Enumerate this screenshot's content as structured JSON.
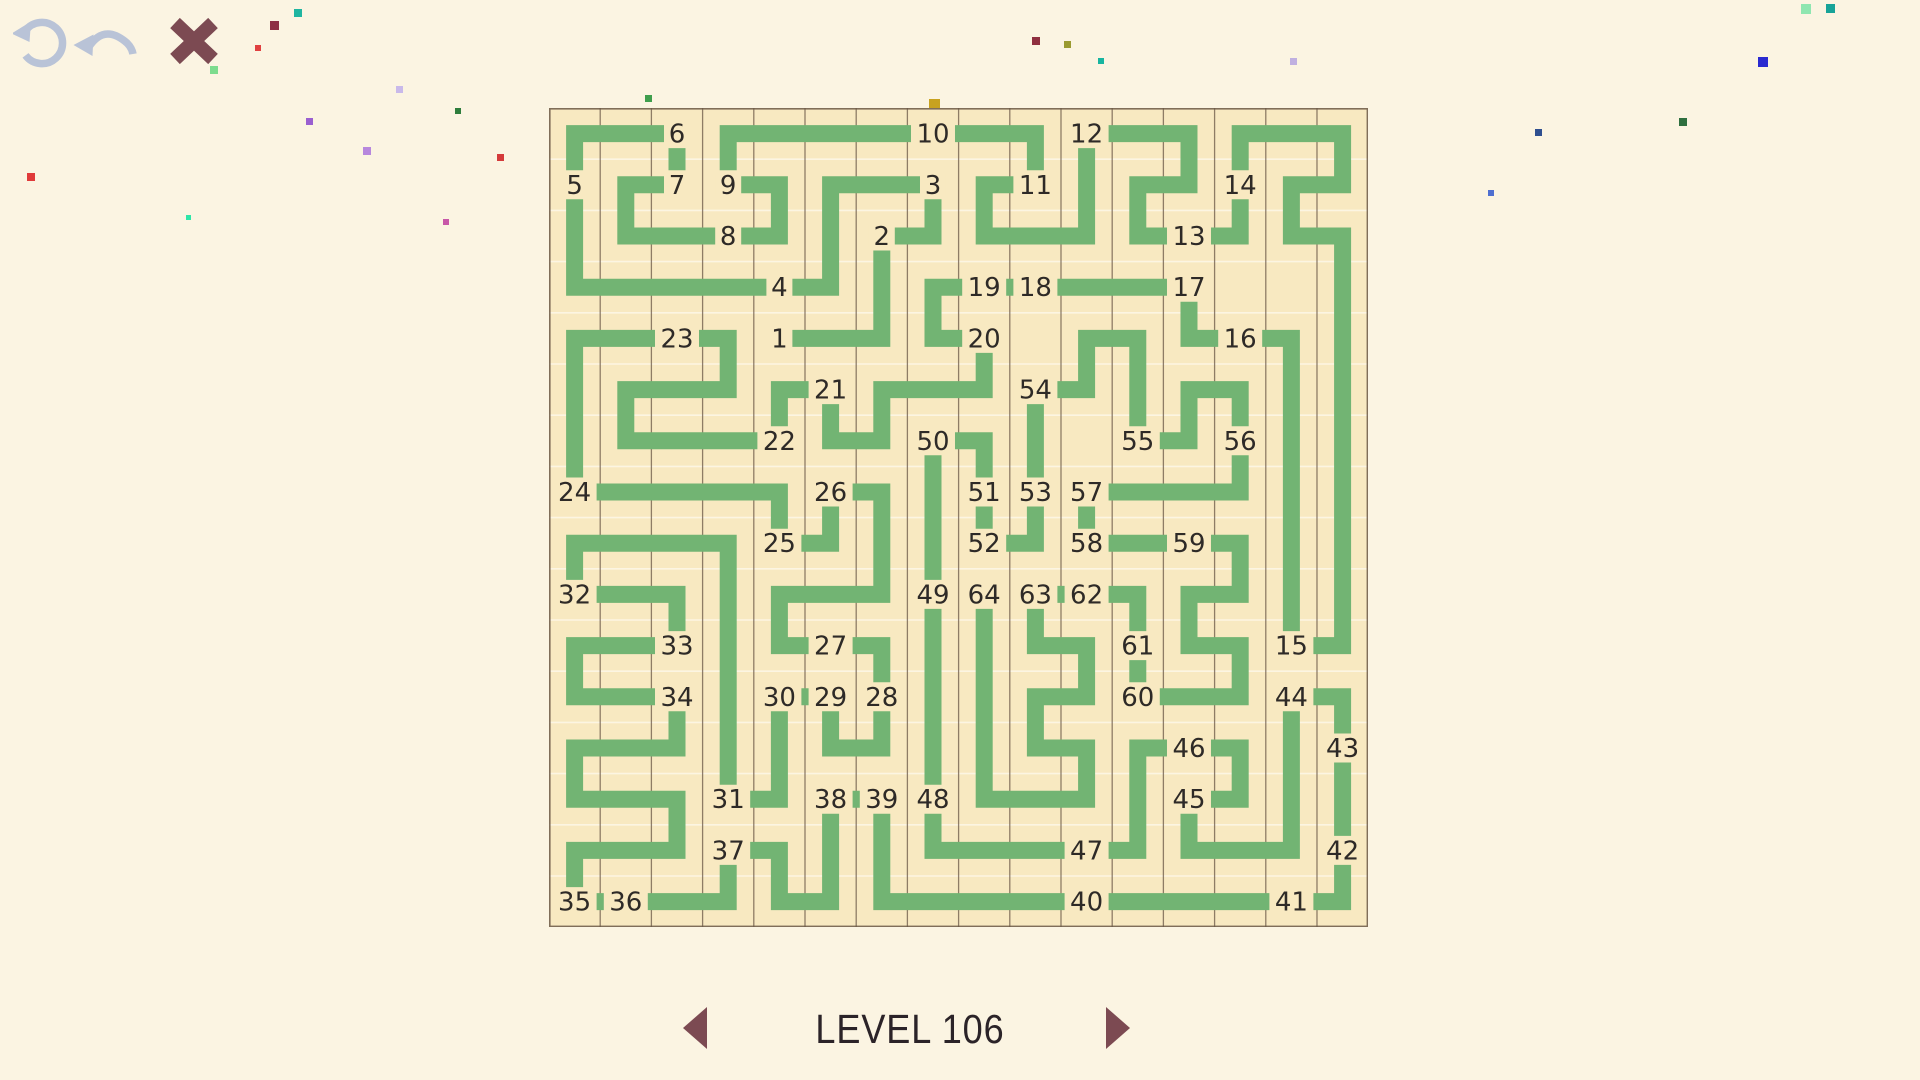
{
  "window": {
    "width": 1920,
    "height": 1080,
    "background": "#fbf4e2"
  },
  "toolbar": {
    "restart_icon_color": "#b9c3d7",
    "undo_icon_color": "#b9c3d7",
    "close_icon_color": "#7c4a52"
  },
  "level_nav": {
    "label": "LEVEL 106",
    "arrow_color": "#7c4a52"
  },
  "maze": {
    "left": 549,
    "top": 108,
    "cols": 16,
    "rows": 16,
    "cell_size": 51.2,
    "colors": {
      "board_bg": "#f8e9c1",
      "path": "#72b473",
      "grid_vertical": "#6b5847",
      "grid_horizontal": "#fdf7e6",
      "border": "#6b5847",
      "number": "#2e2a27",
      "number_halo": "#f8e9c1"
    },
    "path_stroke_width": 17,
    "numbers": [
      {
        "n": 1,
        "c": 4,
        "r": 4
      },
      {
        "n": 2,
        "c": 6,
        "r": 2
      },
      {
        "n": 3,
        "c": 7,
        "r": 1
      },
      {
        "n": 4,
        "c": 4,
        "r": 3
      },
      {
        "n": 5,
        "c": 0,
        "r": 1
      },
      {
        "n": 6,
        "c": 2,
        "r": 0
      },
      {
        "n": 7,
        "c": 2,
        "r": 1
      },
      {
        "n": 8,
        "c": 3,
        "r": 2
      },
      {
        "n": 9,
        "c": 3,
        "r": 1
      },
      {
        "n": 10,
        "c": 7,
        "r": 0
      },
      {
        "n": 11,
        "c": 9,
        "r": 1
      },
      {
        "n": 12,
        "c": 10,
        "r": 0
      },
      {
        "n": 13,
        "c": 12,
        "r": 2
      },
      {
        "n": 14,
        "c": 13,
        "r": 1
      },
      {
        "n": 15,
        "c": 14,
        "r": 10
      },
      {
        "n": 16,
        "c": 13,
        "r": 4
      },
      {
        "n": 17,
        "c": 12,
        "r": 3
      },
      {
        "n": 18,
        "c": 9,
        "r": 3
      },
      {
        "n": 19,
        "c": 8,
        "r": 3
      },
      {
        "n": 20,
        "c": 8,
        "r": 4
      },
      {
        "n": 21,
        "c": 5,
        "r": 5
      },
      {
        "n": 22,
        "c": 4,
        "r": 6
      },
      {
        "n": 23,
        "c": 2,
        "r": 4
      },
      {
        "n": 24,
        "c": 0,
        "r": 7
      },
      {
        "n": 25,
        "c": 4,
        "r": 8
      },
      {
        "n": 26,
        "c": 5,
        "r": 7
      },
      {
        "n": 27,
        "c": 5,
        "r": 10
      },
      {
        "n": 28,
        "c": 6,
        "r": 11
      },
      {
        "n": 29,
        "c": 5,
        "r": 11
      },
      {
        "n": 30,
        "c": 4,
        "r": 11
      },
      {
        "n": 31,
        "c": 3,
        "r": 13
      },
      {
        "n": 32,
        "c": 0,
        "r": 9
      },
      {
        "n": 33,
        "c": 2,
        "r": 10
      },
      {
        "n": 34,
        "c": 2,
        "r": 11
      },
      {
        "n": 35,
        "c": 0,
        "r": 15
      },
      {
        "n": 36,
        "c": 1,
        "r": 15
      },
      {
        "n": 37,
        "c": 3,
        "r": 14
      },
      {
        "n": 38,
        "c": 5,
        "r": 13
      },
      {
        "n": 39,
        "c": 6,
        "r": 13
      },
      {
        "n": 40,
        "c": 10,
        "r": 15
      },
      {
        "n": 41,
        "c": 14,
        "r": 15
      },
      {
        "n": 42,
        "c": 15,
        "r": 14
      },
      {
        "n": 43,
        "c": 15,
        "r": 12
      },
      {
        "n": 44,
        "c": 14,
        "r": 11
      },
      {
        "n": 45,
        "c": 12,
        "r": 13
      },
      {
        "n": 46,
        "c": 12,
        "r": 12
      },
      {
        "n": 47,
        "c": 10,
        "r": 14
      },
      {
        "n": 48,
        "c": 7,
        "r": 13
      },
      {
        "n": 49,
        "c": 7,
        "r": 9
      },
      {
        "n": 50,
        "c": 7,
        "r": 6
      },
      {
        "n": 51,
        "c": 8,
        "r": 7
      },
      {
        "n": 52,
        "c": 8,
        "r": 8
      },
      {
        "n": 53,
        "c": 9,
        "r": 7
      },
      {
        "n": 54,
        "c": 9,
        "r": 5
      },
      {
        "n": 55,
        "c": 11,
        "r": 6
      },
      {
        "n": 56,
        "c": 13,
        "r": 6
      },
      {
        "n": 57,
        "c": 10,
        "r": 7
      },
      {
        "n": 58,
        "c": 10,
        "r": 8
      },
      {
        "n": 59,
        "c": 12,
        "r": 8
      },
      {
        "n": 60,
        "c": 11,
        "r": 11
      },
      {
        "n": 61,
        "c": 11,
        "r": 10
      },
      {
        "n": 62,
        "c": 10,
        "r": 9
      },
      {
        "n": 63,
        "c": 9,
        "r": 9
      },
      {
        "n": 64,
        "c": 8,
        "r": 9
      }
    ],
    "path_cells": [
      [
        4,
        4
      ],
      [
        6,
        4
      ],
      [
        6,
        2
      ],
      [
        7,
        2
      ],
      [
        7,
        1
      ],
      [
        5,
        1
      ],
      [
        5,
        3
      ],
      [
        0,
        3
      ],
      [
        0,
        0
      ],
      [
        2,
        0
      ],
      [
        2,
        1
      ],
      [
        1,
        1
      ],
      [
        1,
        2
      ],
      [
        4,
        2
      ],
      [
        4,
        1
      ],
      [
        3,
        1
      ],
      [
        3,
        0
      ],
      [
        9,
        0
      ],
      [
        9,
        1
      ],
      [
        8,
        1
      ],
      [
        8,
        2
      ],
      [
        10,
        2
      ],
      [
        10,
        0
      ],
      [
        12,
        0
      ],
      [
        12,
        1
      ],
      [
        11,
        1
      ],
      [
        11,
        2
      ],
      [
        13,
        2
      ],
      [
        13,
        0
      ],
      [
        15,
        0
      ],
      [
        15,
        1
      ],
      [
        14,
        1
      ],
      [
        14,
        2
      ],
      [
        15,
        2
      ],
      [
        15,
        10
      ],
      [
        14,
        10
      ],
      [
        14,
        4
      ],
      [
        12,
        4
      ],
      [
        12,
        3
      ],
      [
        7,
        3
      ],
      [
        7,
        4
      ],
      [
        8,
        4
      ],
      [
        8,
        5
      ],
      [
        6,
        5
      ],
      [
        6,
        6
      ],
      [
        5,
        6
      ],
      [
        5,
        5
      ],
      [
        4,
        5
      ],
      [
        4,
        6
      ],
      [
        1,
        6
      ],
      [
        1,
        5
      ],
      [
        3,
        5
      ],
      [
        3,
        4
      ],
      [
        0,
        4
      ],
      [
        0,
        7
      ],
      [
        4,
        7
      ],
      [
        4,
        8
      ],
      [
        5,
        8
      ],
      [
        5,
        7
      ],
      [
        6,
        7
      ],
      [
        6,
        9
      ],
      [
        4,
        9
      ],
      [
        4,
        10
      ],
      [
        6,
        10
      ],
      [
        6,
        12
      ],
      [
        5,
        12
      ],
      [
        5,
        11
      ],
      [
        4,
        11
      ],
      [
        4,
        13
      ],
      [
        3,
        13
      ],
      [
        3,
        8
      ],
      [
        0,
        8
      ],
      [
        0,
        9
      ],
      [
        2,
        9
      ],
      [
        2,
        10
      ],
      [
        0,
        10
      ],
      [
        0,
        11
      ],
      [
        2,
        11
      ],
      [
        2,
        12
      ],
      [
        0,
        12
      ],
      [
        0,
        13
      ],
      [
        2,
        13
      ],
      [
        2,
        14
      ],
      [
        0,
        14
      ],
      [
        0,
        15
      ],
      [
        3,
        15
      ],
      [
        3,
        14
      ],
      [
        4,
        14
      ],
      [
        4,
        15
      ],
      [
        5,
        15
      ],
      [
        5,
        13
      ],
      [
        6,
        13
      ],
      [
        6,
        15
      ],
      [
        15,
        15
      ],
      [
        15,
        11
      ],
      [
        14,
        11
      ],
      [
        14,
        14
      ],
      [
        12,
        14
      ],
      [
        12,
        13
      ],
      [
        13,
        13
      ],
      [
        13,
        12
      ],
      [
        11,
        12
      ],
      [
        11,
        14
      ],
      [
        7,
        14
      ],
      [
        7,
        6
      ],
      [
        8,
        6
      ],
      [
        8,
        8
      ],
      [
        9,
        8
      ],
      [
        9,
        5
      ],
      [
        10,
        5
      ],
      [
        10,
        4
      ],
      [
        11,
        4
      ],
      [
        11,
        6
      ],
      [
        12,
        6
      ],
      [
        12,
        5
      ],
      [
        13,
        5
      ],
      [
        13,
        7
      ],
      [
        10,
        7
      ],
      [
        10,
        8
      ],
      [
        13,
        8
      ],
      [
        13,
        9
      ],
      [
        12,
        9
      ],
      [
        12,
        10
      ],
      [
        13,
        10
      ],
      [
        13,
        11
      ],
      [
        11,
        11
      ],
      [
        11,
        9
      ],
      [
        9,
        9
      ],
      [
        9,
        10
      ],
      [
        10,
        10
      ],
      [
        10,
        11
      ],
      [
        9,
        11
      ],
      [
        9,
        12
      ],
      [
        10,
        12
      ],
      [
        10,
        13
      ],
      [
        8,
        13
      ],
      [
        8,
        9
      ]
    ]
  },
  "confetti": [
    {
      "x": 210,
      "y": 66,
      "s": 8,
      "color": "#7ddc8e"
    },
    {
      "x": 270,
      "y": 21,
      "s": 9,
      "color": "#8e3044"
    },
    {
      "x": 294,
      "y": 9,
      "s": 8,
      "color": "#1fb5a0"
    },
    {
      "x": 255,
      "y": 45,
      "s": 6,
      "color": "#e04040"
    },
    {
      "x": 363,
      "y": 147,
      "s": 8,
      "color": "#b787dd"
    },
    {
      "x": 306,
      "y": 118,
      "s": 7,
      "color": "#9a5fd0"
    },
    {
      "x": 455,
      "y": 108,
      "s": 6,
      "color": "#2e7d3c"
    },
    {
      "x": 396,
      "y": 86,
      "s": 7,
      "color": "#c9b9ea"
    },
    {
      "x": 497,
      "y": 154,
      "s": 7,
      "color": "#d43a3a"
    },
    {
      "x": 443,
      "y": 219,
      "s": 6,
      "color": "#c857a8"
    },
    {
      "x": 186,
      "y": 215,
      "s": 5,
      "color": "#2ee6a8"
    },
    {
      "x": 27,
      "y": 173,
      "s": 8,
      "color": "#e03a3a"
    },
    {
      "x": 561,
      "y": 210,
      "s": 13,
      "color": "#9b59d0"
    },
    {
      "x": 571,
      "y": 203,
      "s": 6,
      "color": "#c8b72e"
    },
    {
      "x": 626,
      "y": 218,
      "s": 5,
      "color": "#cc3333"
    },
    {
      "x": 712,
      "y": 155,
      "s": 6,
      "color": "#b08968"
    },
    {
      "x": 653,
      "y": 121,
      "s": 10,
      "color": "#2ee6a8"
    },
    {
      "x": 664,
      "y": 134,
      "s": 8,
      "color": "#1f7a33"
    },
    {
      "x": 645,
      "y": 95,
      "s": 7,
      "color": "#3f9e4d"
    },
    {
      "x": 743,
      "y": 139,
      "s": 9,
      "color": "#b9a8e0"
    },
    {
      "x": 788,
      "y": 171,
      "s": 12,
      "color": "#a03a4a"
    },
    {
      "x": 929,
      "y": 99,
      "s": 11,
      "color": "#c8a21f"
    },
    {
      "x": 1042,
      "y": 121,
      "s": 6,
      "color": "#2ee6a8"
    },
    {
      "x": 1108,
      "y": 157,
      "s": 11,
      "color": "#e03a3a"
    },
    {
      "x": 1222,
      "y": 190,
      "s": 6,
      "color": "#9b8fd0"
    },
    {
      "x": 1290,
      "y": 58,
      "s": 7,
      "color": "#c0b0e0"
    },
    {
      "x": 1535,
      "y": 129,
      "s": 7,
      "color": "#2f4f8f"
    },
    {
      "x": 1679,
      "y": 118,
      "s": 8,
      "color": "#2e6f3f"
    },
    {
      "x": 1488,
      "y": 190,
      "s": 6,
      "color": "#4f6fd0"
    },
    {
      "x": 1801,
      "y": 4,
      "s": 10,
      "color": "#8fe6b0"
    },
    {
      "x": 1826,
      "y": 4,
      "s": 9,
      "color": "#17a398"
    },
    {
      "x": 1758,
      "y": 57,
      "s": 10,
      "color": "#2a2ad0"
    },
    {
      "x": 1032,
      "y": 37,
      "s": 8,
      "color": "#8f2f3f"
    },
    {
      "x": 1064,
      "y": 41,
      "s": 7,
      "color": "#9a9a30"
    },
    {
      "x": 1098,
      "y": 58,
      "s": 6,
      "color": "#17b5a0"
    }
  ]
}
